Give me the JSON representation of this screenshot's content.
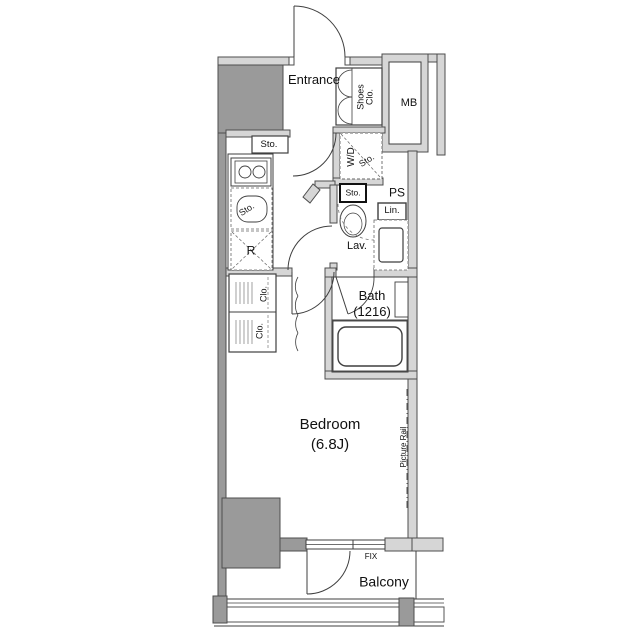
{
  "document_type": "apartment-floor-plan",
  "colors": {
    "background": "#ffffff",
    "wall_fill": "#d6d6d6",
    "wall_stroke": "#4d4d4d",
    "structure_gray": "#9a9a9a",
    "line": "#3f3f3f",
    "text": "#111111"
  },
  "labels": {
    "entrance": "Entrance",
    "shoes_line1": "Shoes",
    "shoes_line2": "Clo.",
    "mb": "MB",
    "hall_sto": "Sto.",
    "wd": "W/D",
    "wd_sto": "Sto.",
    "sink_sto": "Sto.",
    "fridge": "R",
    "toilet_sto": "Sto.",
    "ps": "PS",
    "lin": "Lin.",
    "lav": "Lav.",
    "bath": "Bath",
    "bath_size": "(1216)",
    "clo_top": "Clo.",
    "clo_bottom": "Clo.",
    "bedroom": "Bedroom",
    "bedroom_size": "(6.8J)",
    "picture_rail": "Picture Rail",
    "fix": "FIX",
    "balcony": "Balcony"
  }
}
